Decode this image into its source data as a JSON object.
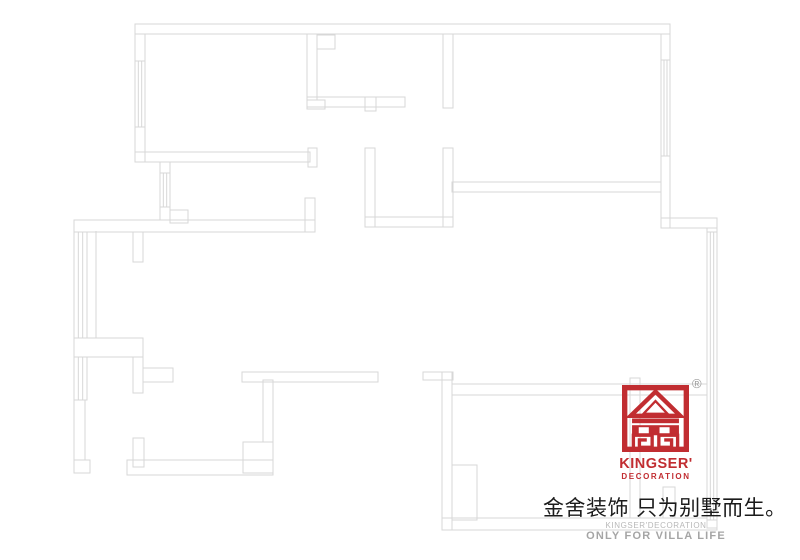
{
  "page": {
    "width": 800,
    "height": 560,
    "background": "#ffffff"
  },
  "floorplan": {
    "line_color": "#d7d7d7",
    "walls": [
      [
        135,
        24,
        535,
        10
      ],
      [
        135,
        34,
        10,
        128
      ],
      [
        135,
        152,
        175,
        10
      ],
      [
        308,
        148,
        9,
        19
      ],
      [
        307,
        34,
        10,
        66
      ],
      [
        307,
        100,
        18,
        9
      ],
      [
        317,
        35,
        18,
        14
      ],
      [
        307,
        97,
        98,
        10
      ],
      [
        365,
        97,
        11,
        14
      ],
      [
        443,
        34,
        10,
        74
      ],
      [
        452,
        182,
        209,
        10
      ],
      [
        661,
        34,
        9,
        194
      ],
      [
        661,
        218,
        56,
        10
      ],
      [
        707,
        228,
        10,
        300
      ],
      [
        365,
        148,
        10,
        79
      ],
      [
        443,
        148,
        10,
        79
      ],
      [
        365,
        217,
        88,
        10
      ],
      [
        74,
        220,
        241,
        12
      ],
      [
        305,
        198,
        10,
        34
      ],
      [
        133,
        232,
        10,
        30
      ],
      [
        160,
        162,
        10,
        58
      ],
      [
        170,
        210,
        18,
        13
      ],
      [
        74,
        338,
        69,
        19
      ],
      [
        133,
        357,
        10,
        36
      ],
      [
        143,
        368,
        30,
        14
      ],
      [
        74,
        400,
        11,
        60
      ],
      [
        74,
        460,
        16,
        13
      ],
      [
        133,
        438,
        11,
        29
      ],
      [
        127,
        460,
        146,
        15
      ],
      [
        263,
        380,
        10,
        62
      ],
      [
        243,
        442,
        30,
        31
      ],
      [
        242,
        372,
        136,
        10
      ],
      [
        423,
        372,
        30,
        8
      ],
      [
        442,
        372,
        10,
        158
      ],
      [
        452,
        384,
        255,
        11
      ],
      [
        442,
        518,
        275,
        12
      ],
      [
        452,
        465,
        25,
        55
      ],
      [
        630,
        378,
        10,
        140
      ],
      [
        663,
        487,
        12,
        31
      ]
    ],
    "windows": [
      [
        135,
        61,
        10,
        66
      ],
      [
        160,
        173,
        10,
        34
      ],
      [
        74,
        232,
        13,
        106
      ],
      [
        74,
        357,
        13,
        43
      ],
      [
        661,
        60,
        9,
        96
      ],
      [
        707,
        232,
        10,
        288
      ]
    ],
    "lines": [
      [
        96,
        231,
        96,
        338
      ]
    ]
  },
  "brand": {
    "accent_color": "#c12d31",
    "registered_mark": "®",
    "name": "KINGSER'",
    "subtitle": "DECORATION",
    "slogan": "金舍装饰 只为别墅而生。",
    "footer_brand": "KINGSER'DECORATION",
    "footer_tagline": "ONLY FOR VILLA LIFE",
    "footer_text_color": "#a5a5a5"
  }
}
